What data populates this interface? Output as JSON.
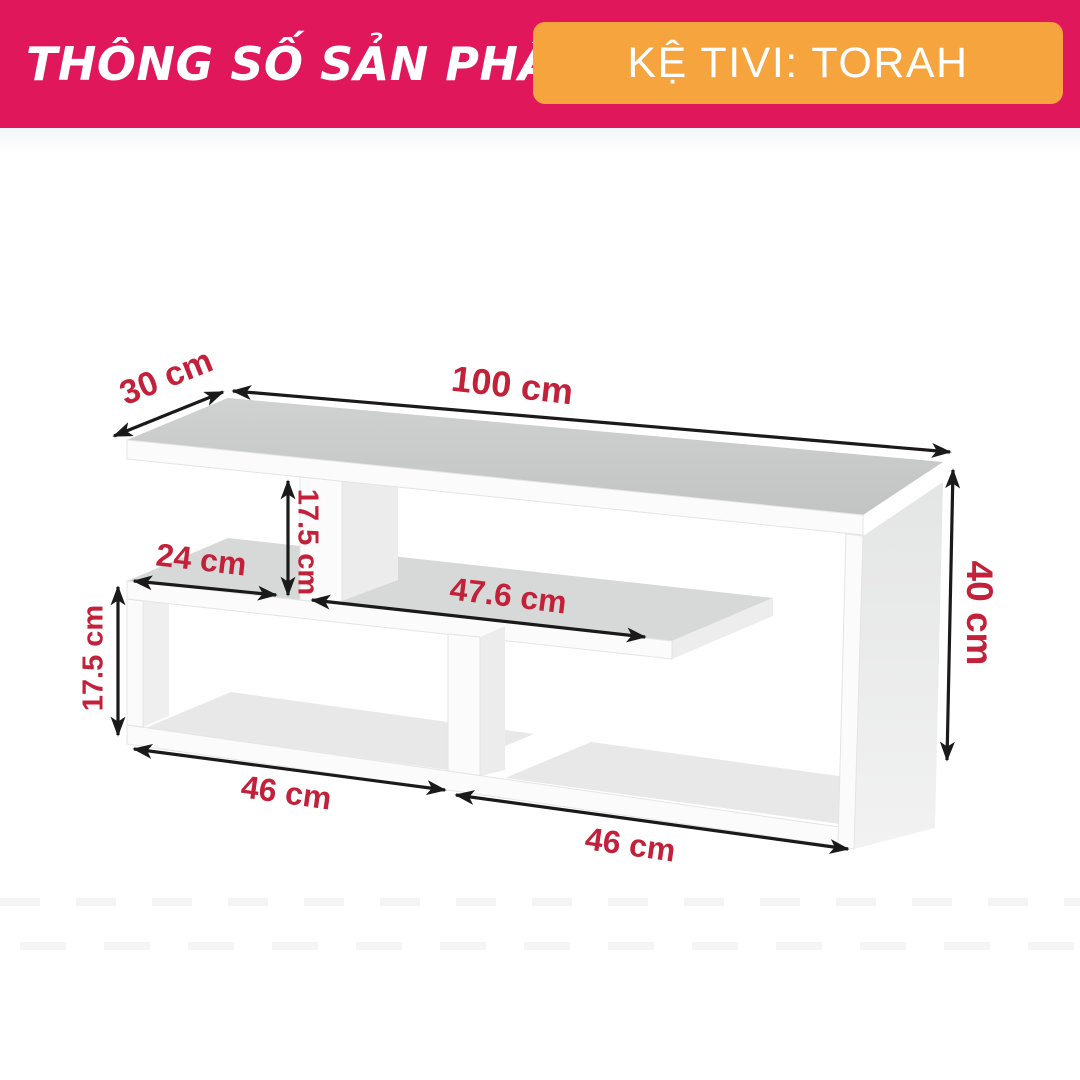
{
  "header": {
    "title": "THÔNG SỐ SẢN PHẨM",
    "badge": "KỆ TIVI: TORAH",
    "colors": {
      "band": "#e1175c",
      "badge": "#f5a43e",
      "text": "#ffffff"
    }
  },
  "diagram": {
    "unit": "cm",
    "label_color": "#c3213a",
    "dimensions": {
      "depth": "30 cm",
      "width": "100 cm",
      "top_gap_height": "17.5 cm",
      "shelf_left_length": "24 cm",
      "shelf_right_length": "47.6 cm",
      "total_height": "40 cm",
      "left_box_height": "17.5 cm",
      "left_compartment_width": "46 cm",
      "right_compartment_width": "46 cm"
    }
  }
}
